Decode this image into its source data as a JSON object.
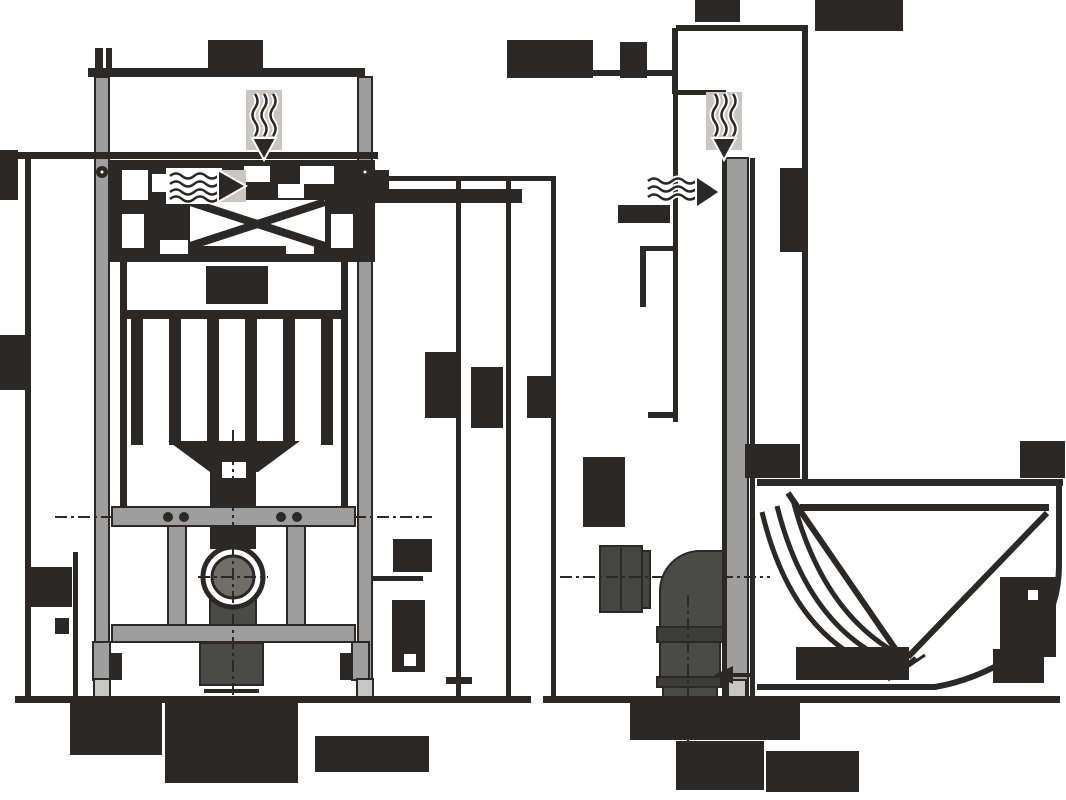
{
  "diagram": {
    "type": "technical-installation-drawing",
    "subject": "wall-hung-wc-mounting-frame",
    "views": [
      {
        "id": "front-elevation",
        "side": "left"
      },
      {
        "id": "side-section-with-bowl",
        "side": "right"
      }
    ],
    "colors": {
      "ink": "#2b2828",
      "rail": "#9e9e9e",
      "pad": "#c6c6c4",
      "metal": "#4a4a48",
      "metal_dark": "#3c3c3a",
      "bracket": "#454543",
      "drain": "#706e68",
      "halo": "#c9c7c4",
      "background": "#ffffff"
    },
    "icons": [
      {
        "name": "odour-extraction-arrow-front",
        "glyph": "wavy-air-down-arrow"
      },
      {
        "name": "odour-extraction-arrow-side",
        "glyph": "wavy-air-down-arrow"
      },
      {
        "name": "water-inlet-arrow-front",
        "glyph": "wavy-water-right-arrow"
      },
      {
        "name": "water-inlet-arrow-side",
        "glyph": "wavy-water-right-arrow"
      }
    ],
    "redacted_labels": [
      {
        "id": "front-top-width-dim",
        "x": 208,
        "y": 40,
        "w": 55,
        "h": 32
      },
      {
        "id": "front-left-upper-dim",
        "x": 0,
        "y": 150,
        "w": 18,
        "h": 50
      },
      {
        "id": "front-left-mid-dim",
        "x": 0,
        "y": 335,
        "w": 25,
        "h": 55
      },
      {
        "id": "front-left-lower-dim",
        "x": 30,
        "y": 567,
        "w": 42,
        "h": 40
      },
      {
        "id": "front-left-small-tick",
        "x": 55,
        "y": 618,
        "w": 14,
        "h": 16
      },
      {
        "id": "front-right-top-row",
        "x": 375,
        "y": 189,
        "w": 147,
        "h": 14
      },
      {
        "id": "front-height-dim-1",
        "x": 425,
        "y": 352,
        "w": 31,
        "h": 66
      },
      {
        "id": "front-height-dim-2",
        "x": 471,
        "y": 367,
        "w": 32,
        "h": 61
      },
      {
        "id": "front-height-dim-3",
        "x": 527,
        "y": 376,
        "w": 28,
        "h": 42
      },
      {
        "id": "front-rail-dim-upper",
        "x": 393,
        "y": 539,
        "w": 39,
        "h": 33
      },
      {
        "id": "front-rail-dim-lower",
        "x": 392,
        "y": 600,
        "w": 33,
        "h": 72,
        "holes": [
          {
            "x": 404,
            "y": 654,
            "w": 12,
            "h": 12
          }
        ]
      },
      {
        "id": "front-center-label",
        "x": 206,
        "y": 266,
        "w": 62,
        "h": 38
      },
      {
        "id": "front-floor-label-left",
        "x": 70,
        "y": 702,
        "w": 92,
        "h": 53
      },
      {
        "id": "front-floor-label-center",
        "x": 165,
        "y": 702,
        "w": 133,
        "h": 81
      },
      {
        "id": "front-floor-label-right",
        "x": 315,
        "y": 736,
        "w": 114,
        "h": 36
      },
      {
        "id": "side-range-label",
        "x": 507,
        "y": 40,
        "w": 86,
        "h": 38
      },
      {
        "id": "side-range-label-2",
        "x": 620,
        "y": 42,
        "w": 27,
        "h": 36
      },
      {
        "id": "side-top-dim",
        "x": 695,
        "y": 0,
        "w": 45,
        "h": 22
      },
      {
        "id": "side-top-right-dim",
        "x": 815,
        "y": 0,
        "w": 88,
        "h": 31
      },
      {
        "id": "side-right-vertical-dim",
        "x": 780,
        "y": 168,
        "w": 27,
        "h": 84
      },
      {
        "id": "side-water-label",
        "x": 618,
        "y": 205,
        "w": 52,
        "h": 18
      },
      {
        "id": "side-bracket-label",
        "x": 583,
        "y": 457,
        "w": 42,
        "h": 70
      },
      {
        "id": "side-bowl-left-label",
        "x": 745,
        "y": 444,
        "w": 55,
        "h": 34
      },
      {
        "id": "side-bowl-right-label",
        "x": 1020,
        "y": 441,
        "w": 45,
        "h": 37
      },
      {
        "id": "side-bowl-inner-label",
        "x": 1000,
        "y": 577,
        "w": 56,
        "h": 80,
        "holes": [
          {
            "x": 1028,
            "y": 590,
            "w": 10,
            "h": 10
          }
        ]
      },
      {
        "id": "side-floor-label-1",
        "x": 630,
        "y": 702,
        "w": 170,
        "h": 38
      },
      {
        "id": "side-floor-label-2",
        "x": 676,
        "y": 741,
        "w": 88,
        "h": 49
      },
      {
        "id": "side-floor-label-3",
        "x": 766,
        "y": 751,
        "w": 93,
        "h": 41
      },
      {
        "id": "side-slope-label-left",
        "x": 796,
        "y": 647,
        "w": 113,
        "h": 33
      },
      {
        "id": "side-slope-label-right",
        "x": 993,
        "y": 649,
        "w": 51,
        "h": 34
      }
    ]
  }
}
